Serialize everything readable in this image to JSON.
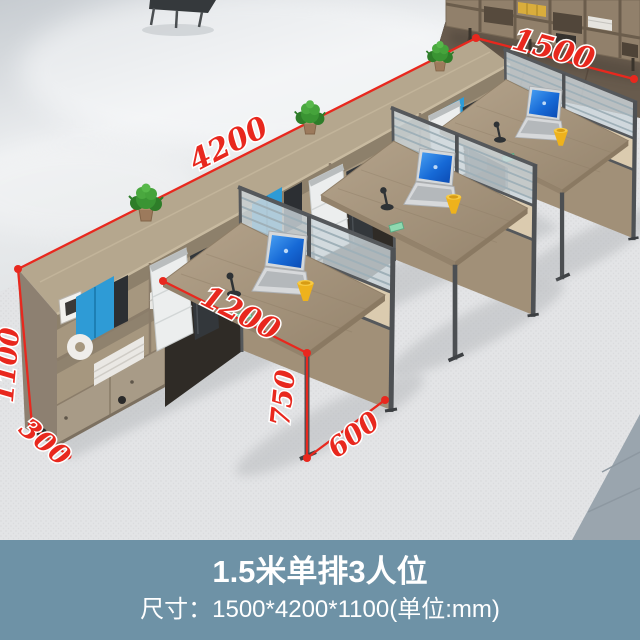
{
  "caption": {
    "title": "1.5米单排3人位",
    "subtitle": "尺寸：1500*4200*1100(单位:mm)"
  },
  "dimensions": {
    "row_length_mm": "4200",
    "total_depth_mm": "1500",
    "total_height_mm": "1100",
    "cabinet_depth_mm": "300",
    "desk_depth_mm": "1200",
    "desk_height_mm": "750",
    "desk_width_mm": "600",
    "unit": "mm"
  },
  "colors": {
    "annotation_red": "#e8281e",
    "caption_band_blue": "#6e92a6",
    "carpet_gray": "#e3e4e6",
    "concrete_floor": "#d9dcdf",
    "wood_floor_brown": "#685b4d",
    "tile_blue_gray": "#9aa5ae",
    "desk_wood": "#a3927b",
    "cabinet_wood": "#a6977f",
    "partition_beige": "#dbcbaf",
    "frame_gray": "#55585b",
    "laptop_screen_blue": "#1669d6",
    "cup_yellow": "#f2b220",
    "plant_green": "#3a9433"
  },
  "objects": {
    "scene": "three-person office workstation row with side storage cabinet, partition screens, laptops, plants"
  }
}
